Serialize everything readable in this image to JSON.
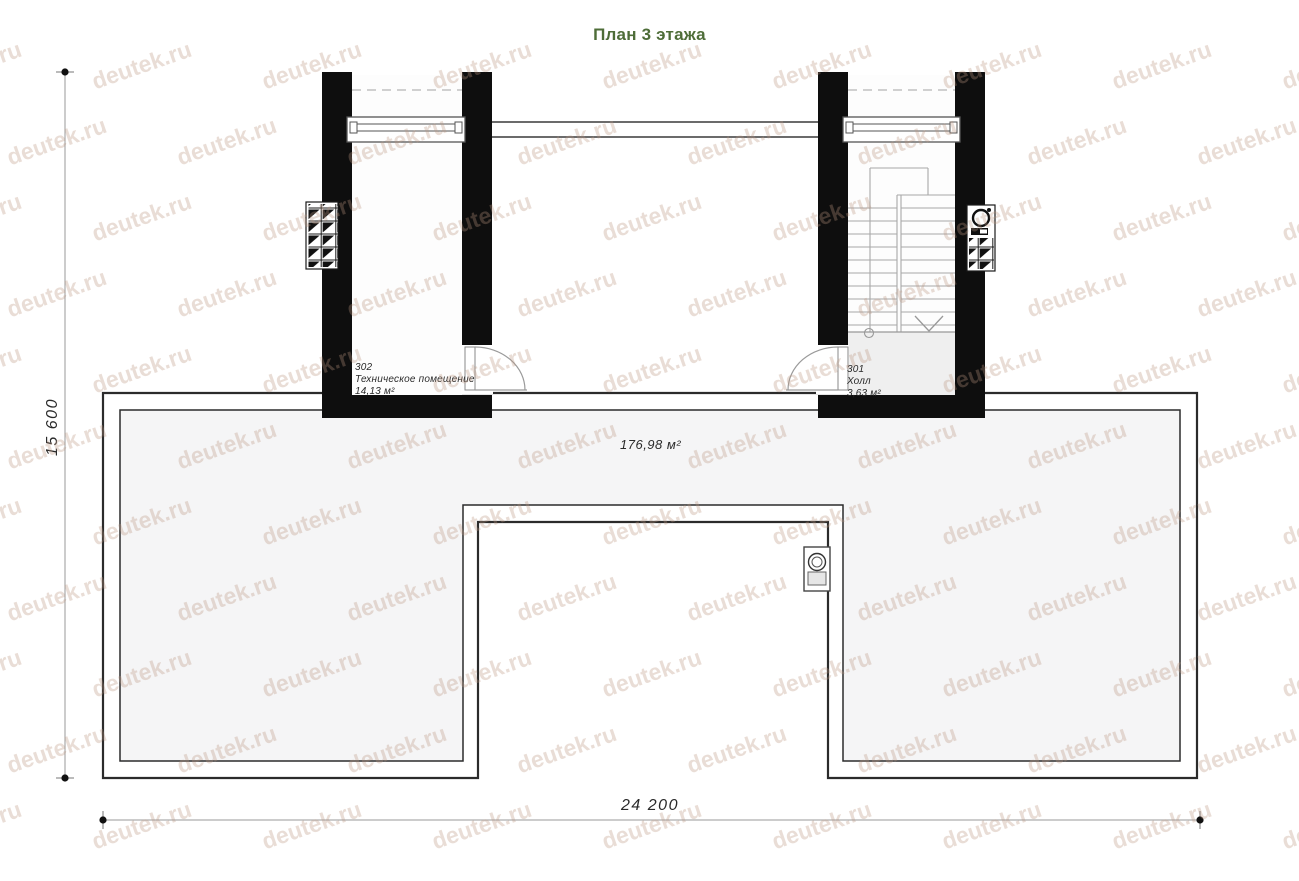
{
  "title": "План 3 этажа",
  "colors": {
    "title": "#4e6d38",
    "wall": "#0e0e0e",
    "outline": "#2b2b2b",
    "roof_fill": "#f5f5f6",
    "hall_fill": "#efefef",
    "stair_line": "#a8a8a8",
    "watermark": "rgba(186,148,128,0.32)"
  },
  "watermark": {
    "text": "deutek.ru"
  },
  "rooms": [
    {
      "number": "302",
      "name": "Техническое помещение",
      "area": "14,13 м²"
    },
    {
      "number": "301",
      "name": "Холл",
      "area": "3,63 м²"
    }
  ],
  "roof": {
    "area_label": "176,98 м²"
  },
  "dimensions": {
    "width_label": "24 200",
    "height_label": "15 600"
  }
}
